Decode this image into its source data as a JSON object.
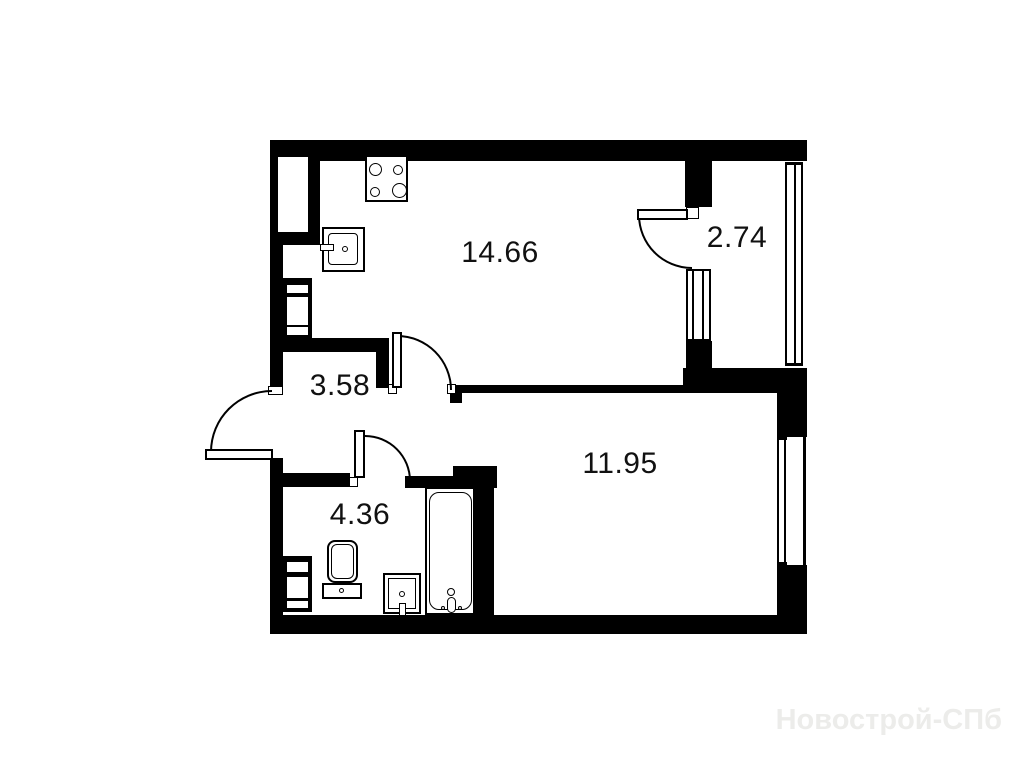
{
  "page": {
    "background": "#ffffff"
  },
  "plan": {
    "type": "apartment-floor-plan",
    "wall_color": "#000000",
    "rooms": [
      {
        "name": "kitchen-living-room",
        "area_label": "14.66"
      },
      {
        "name": "balcony",
        "area_label": "2.74"
      },
      {
        "name": "hallway",
        "area_label": "3.58"
      },
      {
        "name": "room",
        "area_label": "11.95"
      },
      {
        "name": "bathroom",
        "area_label": "4.36"
      }
    ],
    "fixtures": [
      "stove-icon",
      "kitchen-sink-icon",
      "vent-duct-icon",
      "toilet-icon",
      "washbasin-icon",
      "bathtub-icon",
      "vent-duct-icon"
    ],
    "openings": [
      "entrance-door",
      "kitchen-door",
      "bathroom-door",
      "balcony-door",
      "balcony-window",
      "balcony-glazing",
      "room-window"
    ],
    "watermark": {
      "text": "Новострой-СПб",
      "color": "#ececea"
    }
  }
}
